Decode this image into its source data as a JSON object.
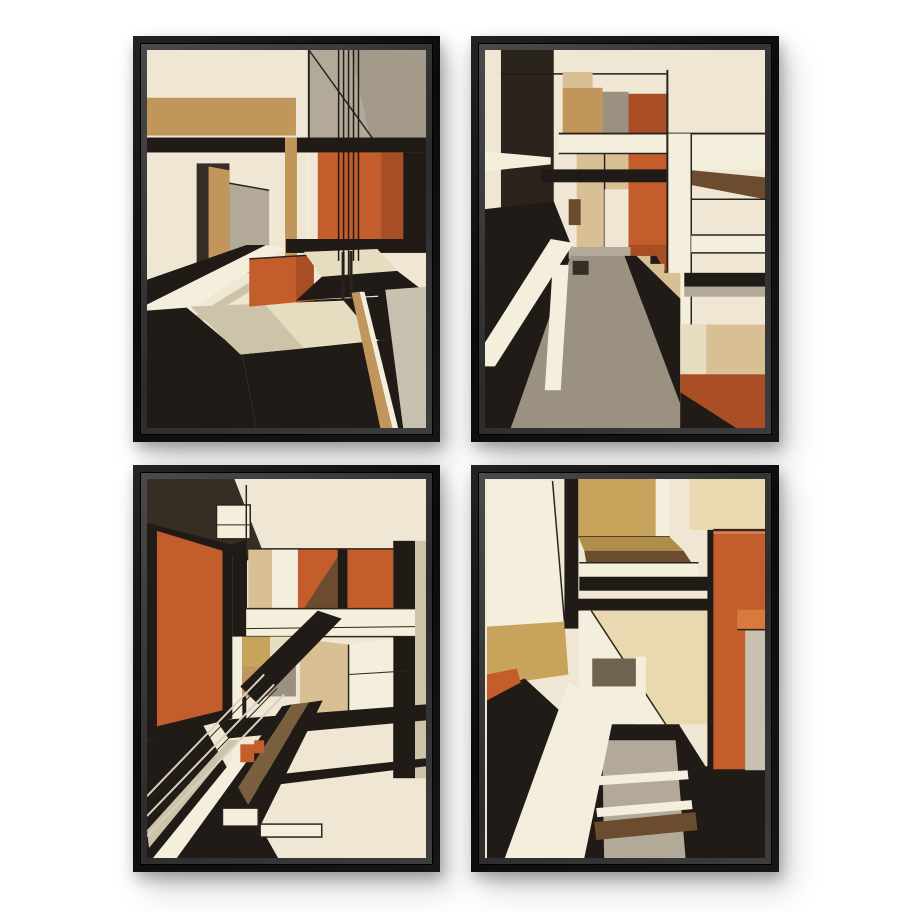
{
  "page": {
    "background": "#ffffff"
  },
  "set": {
    "layout": "2x2 grid of framed prints",
    "frame_color": "#121212",
    "frame_bevel_color": "#3a3a3a",
    "description": "Set of four black-framed abstract geometric architecture art prints in orange, cream, tan, grey and black"
  },
  "frames": [
    {
      "id": "top-left",
      "description": "Abstract perspective corridor with tan band, black beam, vertical line cluster, orange panels, doorway and dark angled floor"
    },
    {
      "id": "top-right",
      "description": "Abstract structure with white beam and column, rust and tan blocks, receding olive walkway and orange lower-right panels"
    },
    {
      "id": "bottom-left",
      "description": "Abstract interior with large orange wall panel, row of orange and tan blocks, white band, diagonal black stair band and striped floor"
    },
    {
      "id": "bottom-right",
      "description": "Abstract hallway with gold ceiling block, orange side panel, grey stone path and bright diagonal light across a dark floor"
    }
  ],
  "palette": {
    "page_bg": "#ffffff",
    "cream": "#efe7d4",
    "cream_bright": "#f4eedd",
    "beige": "#e6dcc0",
    "khaki": "#cdc3a8",
    "tan": "#c2955a",
    "tan_light": "#d9c094",
    "gold": "#c8a35c",
    "gold_dark": "#b08e4a",
    "pale_gold": "#ead9b0",
    "orange": "#c35d2c",
    "orange_light": "#d97a3d",
    "orange_dark": "#a84e24",
    "rust": "#a94e25",
    "brown": "#6b4c2e",
    "brown_mid": "#7a5f3e",
    "dark_brown": "#362e24",
    "olive": "#9a9180",
    "olive_dark": "#6f6450",
    "gray": "#b2a999",
    "gray_light": "#c9c1b0",
    "gray_dark": "#a39a8a",
    "black": "#201b16",
    "ink": "#2b241c",
    "rail": "#d8d0bc"
  }
}
